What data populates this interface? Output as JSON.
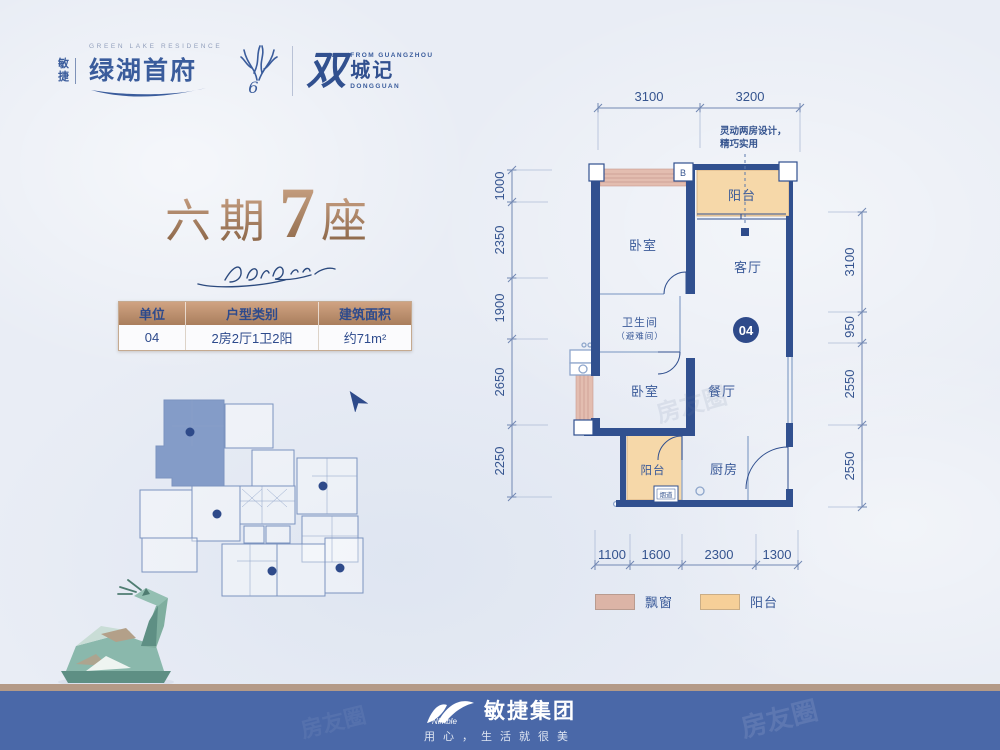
{
  "header": {
    "brand_prefix": "敏捷",
    "brand_en": "GREEN LAKE RESIDENCE",
    "brand_cn": "绿湖首府",
    "brand_mark": "6",
    "logo2_script": "双",
    "logo2_en_top": "FROM GUANGZHOU",
    "logo2_cn": "城记",
    "logo2_en_bottom": "DONGGUAN"
  },
  "title": {
    "part1": "六期",
    "num": "7",
    "part2": "座"
  },
  "table": {
    "headers": [
      "单位",
      "户型类别",
      "建筑面积"
    ],
    "row": [
      "04",
      "2房2厅1卫2阳",
      "约71m²"
    ]
  },
  "plan": {
    "note_line1": "灵动两房设计，",
    "note_line2": "精巧实用",
    "unit_badge": "04",
    "marker_b": "B",
    "rooms": {
      "bedroom1": "卧室",
      "bedroom2": "卧室",
      "living": "客厅",
      "dining": "餐厅",
      "kitchen": "厨房",
      "balcony_top": "阳台",
      "balcony_bottom": "阳台",
      "bath_line1": "卫生间",
      "bath_line2": "（避难间）",
      "flue": "烟道"
    },
    "dims": {
      "top": [
        "3100",
        "3200"
      ],
      "left": [
        "1000",
        "2350",
        "1900",
        "2650",
        "2250"
      ],
      "right": [
        "3100",
        "950",
        "2550",
        "2550"
      ],
      "bottom": [
        "1100",
        "1600",
        "2300",
        "1300"
      ]
    }
  },
  "legend": {
    "items": [
      {
        "label": "飘窗",
        "color": "#dcb4a6"
      },
      {
        "label": "阳台",
        "color": "#f6cf98"
      }
    ]
  },
  "footer": {
    "logo_en": "Nimble",
    "logo_cn": "敏捷集团",
    "tagline": "用心，生活就很美"
  },
  "watermark": "房友圈",
  "colors": {
    "navy_wall": "#31508f",
    "label_navy": "#3a5a99",
    "bronze": "#a07551",
    "balcony_fill": "#f6d8a9",
    "bay_fill": "#e3bdb0",
    "footer_blue": "#4a68a8",
    "footer_tan": "#b49a87"
  }
}
